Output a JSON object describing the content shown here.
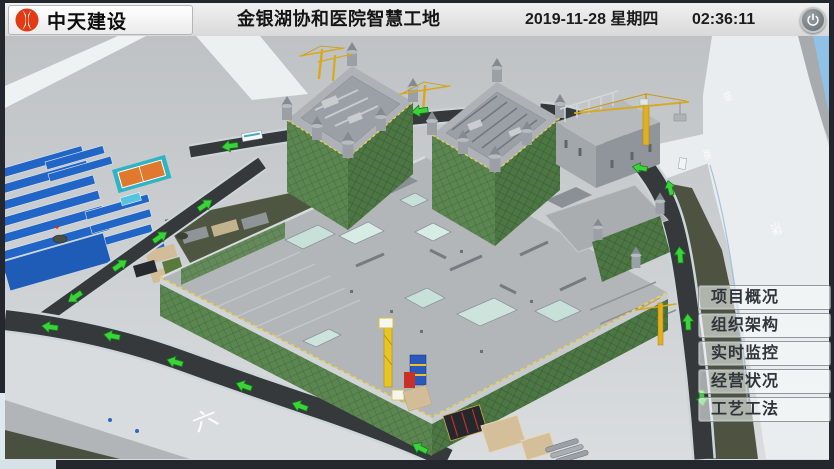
{
  "header": {
    "logo_text": "中天建设",
    "title": "金银湖协和医院智慧工地",
    "date": "2019-11-28 星期四",
    "time": "02:36:11"
  },
  "menu": {
    "items": [
      {
        "label": "项目概况"
      },
      {
        "label": "组织架构"
      },
      {
        "label": "实时监控"
      },
      {
        "label": "经营状况"
      },
      {
        "label": "工艺工法"
      }
    ]
  },
  "scene": {
    "description": "3D BIM model of hospital smart construction site",
    "ground_label": "六",
    "road_labels": [
      "银",
      "路",
      "深"
    ],
    "colors": {
      "arrow_green": "#3bd23b",
      "mesh_green": "#5b8551",
      "road_dark": "#35393c",
      "roof_blue": "#2166c6",
      "crane_yellow": "#e2b01e",
      "lake_blue": "#90c2e8",
      "logo_red": "#e13a14"
    }
  }
}
